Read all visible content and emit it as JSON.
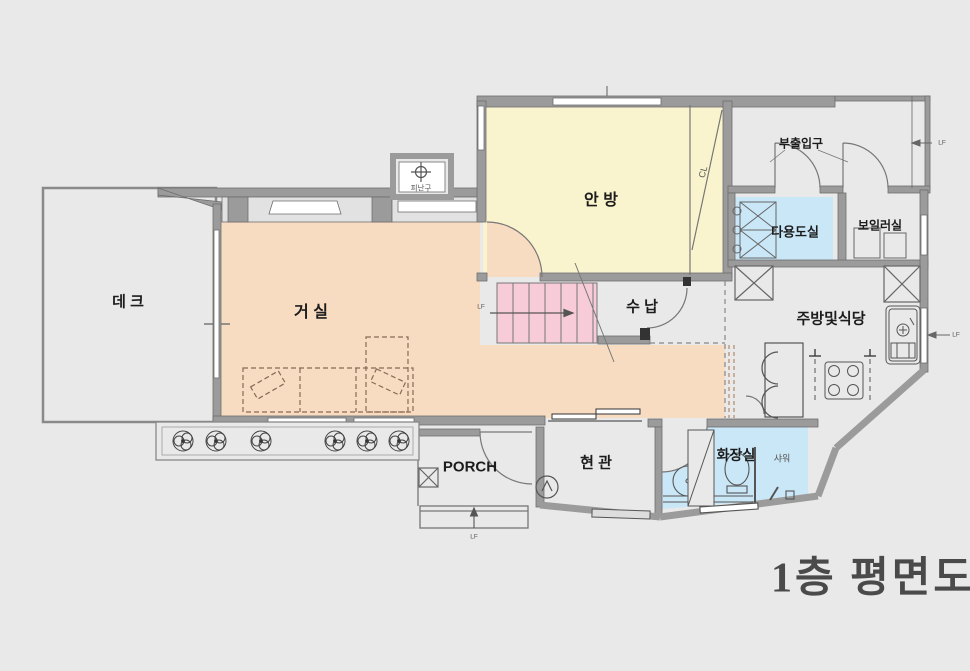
{
  "title": "1층 평면도",
  "rooms": {
    "deck": "데 크",
    "living": "거 실",
    "master": "안 방",
    "storage": "수 납",
    "utility": "다용도실",
    "boiler": "보일러실",
    "kitchen": "주방및식당",
    "entrance": "현 관",
    "porch": "PORCH",
    "bath": "화장실",
    "shower": "샤워",
    "sub_entrance": "부출입구",
    "escape_hatch": "피난구",
    "closet": "CL"
  },
  "markers": {
    "lf": "LF"
  },
  "colors": {
    "background": "#e9e9e9",
    "living_fill": "#f7dcc2",
    "bedroom_fill": "#faf4ce",
    "stairs_fill": "#f7cbd8",
    "wet_fill": "#cae7f7",
    "wall": "#9b9b9b",
    "line": "#6e6e6e",
    "title_text": "#4a4a4a",
    "sofa_dash": "#8a6a55"
  }
}
